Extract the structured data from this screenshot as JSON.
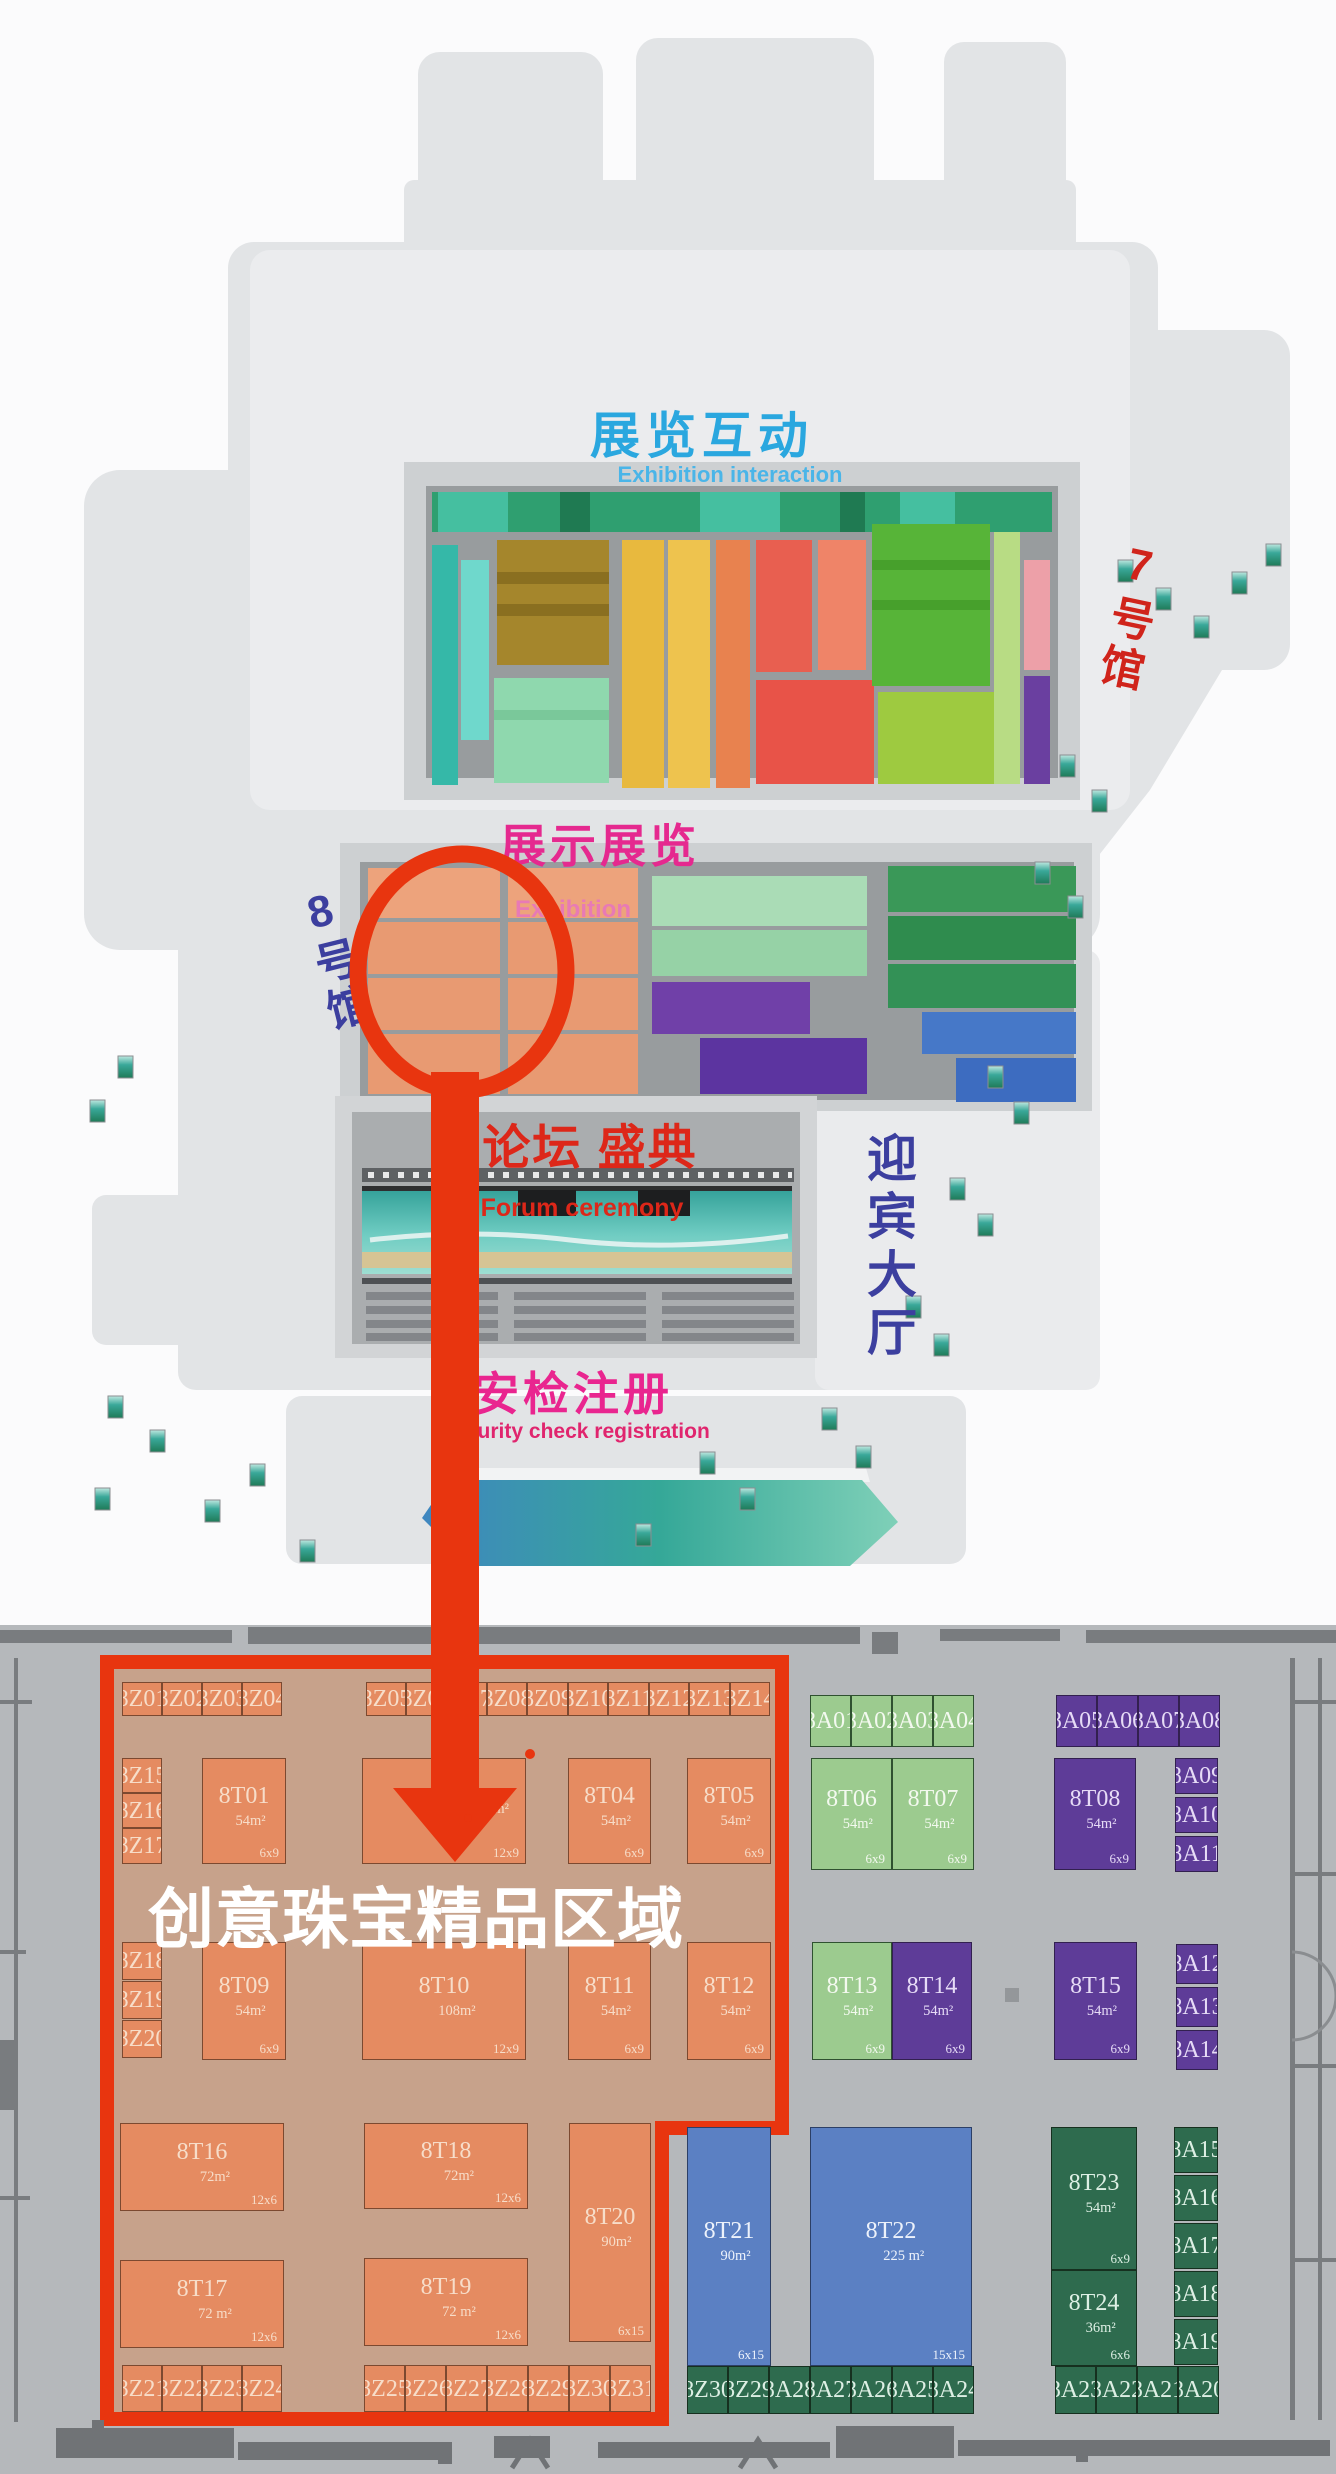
{
  "palette": {
    "highlight_red": "#e8350f",
    "jewelry_area_fill": "#c7a28b",
    "booth_orange": "#e58b61",
    "booth_lightgreen": "#9ccb8f",
    "booth_purple": "#5e3c98",
    "booth_blue": "#5b80c3",
    "booth_darkgreen": "#2e6b4e",
    "floor_grey": "#b5b8bb",
    "label_blue": "#2aa7df",
    "label_magenta": "#e5298f",
    "label_red": "#dd2719",
    "label_navy": "#3c3f9f"
  },
  "overview": {
    "hall7_label": "展览互动",
    "hall7_sublabel": "Exhibition interaction",
    "hall7_tag": "7号馆",
    "hall8_label": "展示展览",
    "hall8_sublabel": "Exhibition",
    "hall8_tag": "8号馆",
    "forum_label": "论坛 盛典",
    "forum_sublabel": "Forum ceremony",
    "lobby_label": "迎宾大厅",
    "security_label": "安检注册",
    "security_sublabel": "Security check registration"
  },
  "annotation": {
    "area_label": "创意珠宝精品区域"
  },
  "floorplan": {
    "booths": [
      {
        "label": "8Z01",
        "x": 122,
        "y": 1682,
        "w": 40,
        "h": 34,
        "c": "or"
      },
      {
        "label": "8Z02",
        "x": 162,
        "y": 1682,
        "w": 40,
        "h": 34,
        "c": "or"
      },
      {
        "label": "8Z03",
        "x": 202,
        "y": 1682,
        "w": 40,
        "h": 34,
        "c": "or"
      },
      {
        "label": "8Z04",
        "x": 242,
        "y": 1682,
        "w": 40,
        "h": 34,
        "c": "or"
      },
      {
        "label": "8Z05",
        "x": 366,
        "y": 1682,
        "w": 40,
        "h": 34,
        "c": "or"
      },
      {
        "label": "8Z06",
        "x": 406,
        "y": 1682,
        "w": 40,
        "h": 34,
        "c": "or"
      },
      {
        "label": "8Z07",
        "x": 446,
        "y": 1682,
        "w": 41,
        "h": 34,
        "c": "or"
      },
      {
        "label": "8Z08",
        "x": 487,
        "y": 1682,
        "w": 40,
        "h": 34,
        "c": "or"
      },
      {
        "label": "8Z09",
        "x": 527,
        "y": 1682,
        "w": 41,
        "h": 34,
        "c": "or"
      },
      {
        "label": "8Z10",
        "x": 568,
        "y": 1682,
        "w": 40,
        "h": 34,
        "c": "or"
      },
      {
        "label": "8Z11",
        "x": 608,
        "y": 1682,
        "w": 41,
        "h": 34,
        "c": "or"
      },
      {
        "label": "8Z12",
        "x": 649,
        "y": 1682,
        "w": 40,
        "h": 34,
        "c": "or"
      },
      {
        "label": "8Z13",
        "x": 689,
        "y": 1682,
        "w": 41,
        "h": 34,
        "c": "or"
      },
      {
        "label": "8Z14",
        "x": 730,
        "y": 1682,
        "w": 40,
        "h": 34,
        "c": "or"
      },
      {
        "label": "8A01",
        "x": 810,
        "y": 1695,
        "w": 41,
        "h": 52,
        "c": "lg"
      },
      {
        "label": "8A02",
        "x": 851,
        "y": 1695,
        "w": 41,
        "h": 52,
        "c": "lg"
      },
      {
        "label": "8A03",
        "x": 892,
        "y": 1695,
        "w": 41,
        "h": 52,
        "c": "lg"
      },
      {
        "label": "8A04",
        "x": 933,
        "y": 1695,
        "w": 41,
        "h": 52,
        "c": "lg"
      },
      {
        "label": "8A05",
        "x": 1056,
        "y": 1695,
        "w": 41,
        "h": 52,
        "c": "pu"
      },
      {
        "label": "8A06",
        "x": 1097,
        "y": 1695,
        "w": 41,
        "h": 52,
        "c": "pu"
      },
      {
        "label": "8A07",
        "x": 1138,
        "y": 1695,
        "w": 41,
        "h": 52,
        "c": "pu"
      },
      {
        "label": "8A08",
        "x": 1179,
        "y": 1695,
        "w": 41,
        "h": 52,
        "c": "pu"
      },
      {
        "label": "8Z15",
        "x": 122,
        "y": 1758,
        "w": 40,
        "h": 35,
        "c": "or"
      },
      {
        "label": "8Z16",
        "x": 122,
        "y": 1793,
        "w": 40,
        "h": 35,
        "c": "or"
      },
      {
        "label": "8Z17",
        "x": 122,
        "y": 1828,
        "w": 40,
        "h": 36,
        "c": "or"
      },
      {
        "label": "8T01",
        "x": 202,
        "y": 1758,
        "w": 84,
        "h": 106,
        "c": "or",
        "a": "54m²",
        "s": "6x9"
      },
      {
        "label": "",
        "x": 362,
        "y": 1758,
        "w": 164,
        "h": 106,
        "c": "or",
        "a": "m²",
        "s": "12x9",
        "ar": 1
      },
      {
        "label": "8T04",
        "x": 568,
        "y": 1758,
        "w": 83,
        "h": 106,
        "c": "or",
        "a": "54m²",
        "s": "6x9"
      },
      {
        "label": "8T05",
        "x": 687,
        "y": 1758,
        "w": 84,
        "h": 106,
        "c": "or",
        "a": "54m²",
        "s": "6x9"
      },
      {
        "label": "8T06",
        "x": 811,
        "y": 1758,
        "w": 81,
        "h": 112,
        "c": "lg",
        "a": "54m²",
        "s": "6x9"
      },
      {
        "label": "8T07",
        "x": 892,
        "y": 1758,
        "w": 82,
        "h": 112,
        "c": "lg",
        "a": "54m²",
        "s": "6x9"
      },
      {
        "label": "8T08",
        "x": 1054,
        "y": 1758,
        "w": 82,
        "h": 112,
        "c": "pu",
        "a": "54m²",
        "s": "6x9"
      },
      {
        "label": "8A09",
        "x": 1175,
        "y": 1758,
        "w": 43,
        "h": 36,
        "c": "pu"
      },
      {
        "label": "8A10",
        "x": 1175,
        "y": 1797,
        "w": 43,
        "h": 36,
        "c": "pu"
      },
      {
        "label": "8A11",
        "x": 1175,
        "y": 1836,
        "w": 43,
        "h": 36,
        "c": "pu"
      },
      {
        "label": "8Z18",
        "x": 122,
        "y": 1942,
        "w": 40,
        "h": 38,
        "c": "or"
      },
      {
        "label": "8Z19",
        "x": 122,
        "y": 1981,
        "w": 40,
        "h": 38,
        "c": "or"
      },
      {
        "label": "8Z20",
        "x": 122,
        "y": 2020,
        "w": 40,
        "h": 38,
        "c": "or"
      },
      {
        "label": "8T09",
        "x": 202,
        "y": 1942,
        "w": 84,
        "h": 118,
        "c": "or",
        "a": "54m²",
        "s": "6x9"
      },
      {
        "label": "8T10",
        "x": 362,
        "y": 1942,
        "w": 164,
        "h": 118,
        "c": "or",
        "a": "108m²",
        "s": "12x9"
      },
      {
        "label": "8T11",
        "x": 568,
        "y": 1942,
        "w": 83,
        "h": 118,
        "c": "or",
        "a": "54m²",
        "s": "6x9"
      },
      {
        "label": "8T12",
        "x": 687,
        "y": 1942,
        "w": 84,
        "h": 118,
        "c": "or",
        "a": "54m²",
        "s": "6x9"
      },
      {
        "label": "8T13",
        "x": 812,
        "y": 1942,
        "w": 80,
        "h": 118,
        "c": "lg",
        "a": "54m²",
        "s": "6x9"
      },
      {
        "label": "8T14",
        "x": 892,
        "y": 1942,
        "w": 80,
        "h": 118,
        "c": "pu",
        "a": "54m²",
        "s": "6x9"
      },
      {
        "label": "8T15",
        "x": 1054,
        "y": 1942,
        "w": 83,
        "h": 118,
        "c": "pu",
        "a": "54m²",
        "s": "6x9"
      },
      {
        "label": "8A12",
        "x": 1176,
        "y": 1944,
        "w": 42,
        "h": 40,
        "c": "pu"
      },
      {
        "label": "8A13",
        "x": 1176,
        "y": 1987,
        "w": 42,
        "h": 40,
        "c": "pu"
      },
      {
        "label": "8A14",
        "x": 1176,
        "y": 2030,
        "w": 42,
        "h": 40,
        "c": "pu"
      },
      {
        "label": "8T16",
        "x": 120,
        "y": 2123,
        "w": 164,
        "h": 88,
        "c": "or",
        "a": "72m²",
        "s": "12x6"
      },
      {
        "label": "8T18",
        "x": 364,
        "y": 2123,
        "w": 164,
        "h": 86,
        "c": "or",
        "a": "72m²",
        "s": "12x6"
      },
      {
        "label": "8T20",
        "x": 569,
        "y": 2123,
        "w": 82,
        "h": 219,
        "c": "or",
        "a": "90m²",
        "s": "6x15"
      },
      {
        "label": "8T17",
        "x": 120,
        "y": 2260,
        "w": 164,
        "h": 88,
        "c": "or",
        "a": "72 m²",
        "s": "12x6"
      },
      {
        "label": "8T19",
        "x": 364,
        "y": 2258,
        "w": 164,
        "h": 88,
        "c": "or",
        "a": "72 m²",
        "s": "12x6"
      },
      {
        "label": "8T21",
        "x": 687,
        "y": 2127,
        "w": 84,
        "h": 239,
        "c": "blu",
        "a": "90m²",
        "s": "6x15"
      },
      {
        "label": "8T22",
        "x": 810,
        "y": 2127,
        "w": 162,
        "h": 239,
        "c": "blu",
        "a": "225 m²",
        "s": "15x15"
      },
      {
        "label": "8T23",
        "x": 1051,
        "y": 2127,
        "w": 86,
        "h": 143,
        "c": "dg",
        "a": "54m²",
        "s": "6x9"
      },
      {
        "label": "8T24",
        "x": 1051,
        "y": 2270,
        "w": 86,
        "h": 96,
        "c": "dg",
        "a": "36m²",
        "s": "6x6"
      },
      {
        "label": "8A15",
        "x": 1174,
        "y": 2127,
        "w": 44,
        "h": 46,
        "c": "dg"
      },
      {
        "label": "8A16",
        "x": 1174,
        "y": 2175,
        "w": 44,
        "h": 46,
        "c": "dg"
      },
      {
        "label": "8A17",
        "x": 1174,
        "y": 2223,
        "w": 44,
        "h": 46,
        "c": "dg"
      },
      {
        "label": "8A18",
        "x": 1174,
        "y": 2271,
        "w": 44,
        "h": 46,
        "c": "dg"
      },
      {
        "label": "8A19",
        "x": 1174,
        "y": 2319,
        "w": 44,
        "h": 46,
        "c": "dg"
      },
      {
        "label": "8Z21",
        "x": 122,
        "y": 2365,
        "w": 40,
        "h": 47,
        "c": "or"
      },
      {
        "label": "8Z22",
        "x": 162,
        "y": 2365,
        "w": 40,
        "h": 47,
        "c": "or"
      },
      {
        "label": "8Z23",
        "x": 202,
        "y": 2365,
        "w": 40,
        "h": 47,
        "c": "or"
      },
      {
        "label": "8Z24",
        "x": 242,
        "y": 2365,
        "w": 40,
        "h": 47,
        "c": "or"
      },
      {
        "label": "8Z25",
        "x": 364,
        "y": 2365,
        "w": 41,
        "h": 47,
        "c": "or"
      },
      {
        "label": "8Z26",
        "x": 405,
        "y": 2365,
        "w": 41,
        "h": 47,
        "c": "or"
      },
      {
        "label": "8Z27",
        "x": 446,
        "y": 2365,
        "w": 41,
        "h": 47,
        "c": "or"
      },
      {
        "label": "8Z28",
        "x": 487,
        "y": 2365,
        "w": 41,
        "h": 47,
        "c": "or"
      },
      {
        "label": "8Z29",
        "x": 528,
        "y": 2365,
        "w": 41,
        "h": 47,
        "c": "or"
      },
      {
        "label": "8Z30",
        "x": 569,
        "y": 2365,
        "w": 41,
        "h": 47,
        "c": "or"
      },
      {
        "label": "8Z31",
        "x": 610,
        "y": 2365,
        "w": 41,
        "h": 47,
        "c": "or"
      },
      {
        "label": "8Z30",
        "x": 687,
        "y": 2366,
        "w": 41,
        "h": 48,
        "c": "dg"
      },
      {
        "label": "8Z29",
        "x": 728,
        "y": 2366,
        "w": 41,
        "h": 48,
        "c": "dg"
      },
      {
        "label": "8A28",
        "x": 769,
        "y": 2366,
        "w": 41,
        "h": 48,
        "c": "dg"
      },
      {
        "label": "8A27",
        "x": 810,
        "y": 2366,
        "w": 41,
        "h": 48,
        "c": "dg"
      },
      {
        "label": "8A26",
        "x": 851,
        "y": 2366,
        "w": 41,
        "h": 48,
        "c": "dg"
      },
      {
        "label": "8A25",
        "x": 892,
        "y": 2366,
        "w": 41,
        "h": 48,
        "c": "dg"
      },
      {
        "label": "8A24",
        "x": 933,
        "y": 2366,
        "w": 41,
        "h": 48,
        "c": "dg"
      },
      {
        "label": "8A23",
        "x": 1055,
        "y": 2366,
        "w": 41,
        "h": 48,
        "c": "dg"
      },
      {
        "label": "8A22",
        "x": 1096,
        "y": 2366,
        "w": 41,
        "h": 48,
        "c": "dg"
      },
      {
        "label": "8A21",
        "x": 1137,
        "y": 2366,
        "w": 41,
        "h": 48,
        "c": "dg"
      },
      {
        "label": "8A20",
        "x": 1178,
        "y": 2366,
        "w": 41,
        "h": 48,
        "c": "dg"
      }
    ]
  }
}
